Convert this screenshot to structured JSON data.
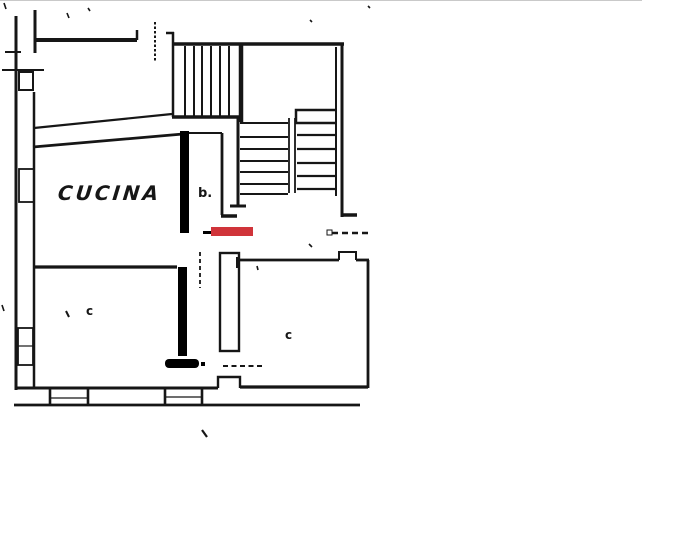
{
  "labels": {
    "kitchen": "CUCINA",
    "stair_hall": "b.",
    "room_left": "c",
    "room_right": "c"
  },
  "colors": {
    "background": "#ffffff",
    "ink": "#161616",
    "annotation-black": "#000000",
    "annotation-red": "#d0343a",
    "scan-edge": "#c9c9c9"
  }
}
